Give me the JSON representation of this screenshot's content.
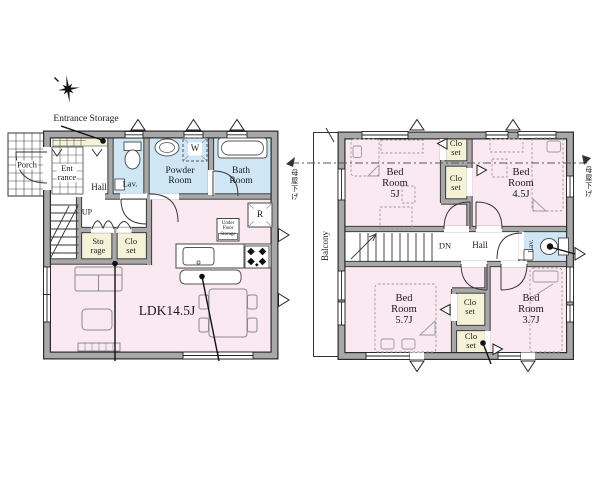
{
  "title": "2-story house floor plan",
  "colors": {
    "room_pink": "#fbe9f1",
    "wet_blue": "#cfe6f4",
    "closet_yellow": "#f6f2d8",
    "wall_gray": "#a8a8a8",
    "line_black": "#222222"
  },
  "floor1": {
    "annotations": {
      "entrance_storage": "Entrance Storage"
    },
    "rooms": {
      "porch": "Porch",
      "entrance": "Ent\nrance",
      "hall": "Hall",
      "lav": "Lav.",
      "powder": "Powder\nRoom",
      "bath": "Bath\nRoom",
      "storage": "Sto\nrage",
      "closet": "Clo\nset",
      "ldk": "LDK14.5J"
    },
    "fixtures": {
      "washer": "W",
      "fridge": "R",
      "underfloor": "Under\nFloor\nStorage",
      "stairs_up": "UP"
    }
  },
  "floor2": {
    "rooms": {
      "balcony": "Balcony",
      "bed5": "Bed\nRoom\n5J",
      "bed45": "Bed\nRoom\n4.5J",
      "bed57": "Bed\nRoom\n5.7J",
      "bed37": "Bed\nRoom\n3.7J",
      "closet_a": "Clo\nset",
      "closet_b": "Clo\nset",
      "closet_c": "Clo\nset",
      "closet_d": "Clo\nset",
      "hall": "Hall",
      "lav": "Lav.",
      "stairs_down": "DN"
    },
    "annotations": {
      "moya_left": "母屋下げ",
      "moya_right": "母屋下げ"
    }
  }
}
